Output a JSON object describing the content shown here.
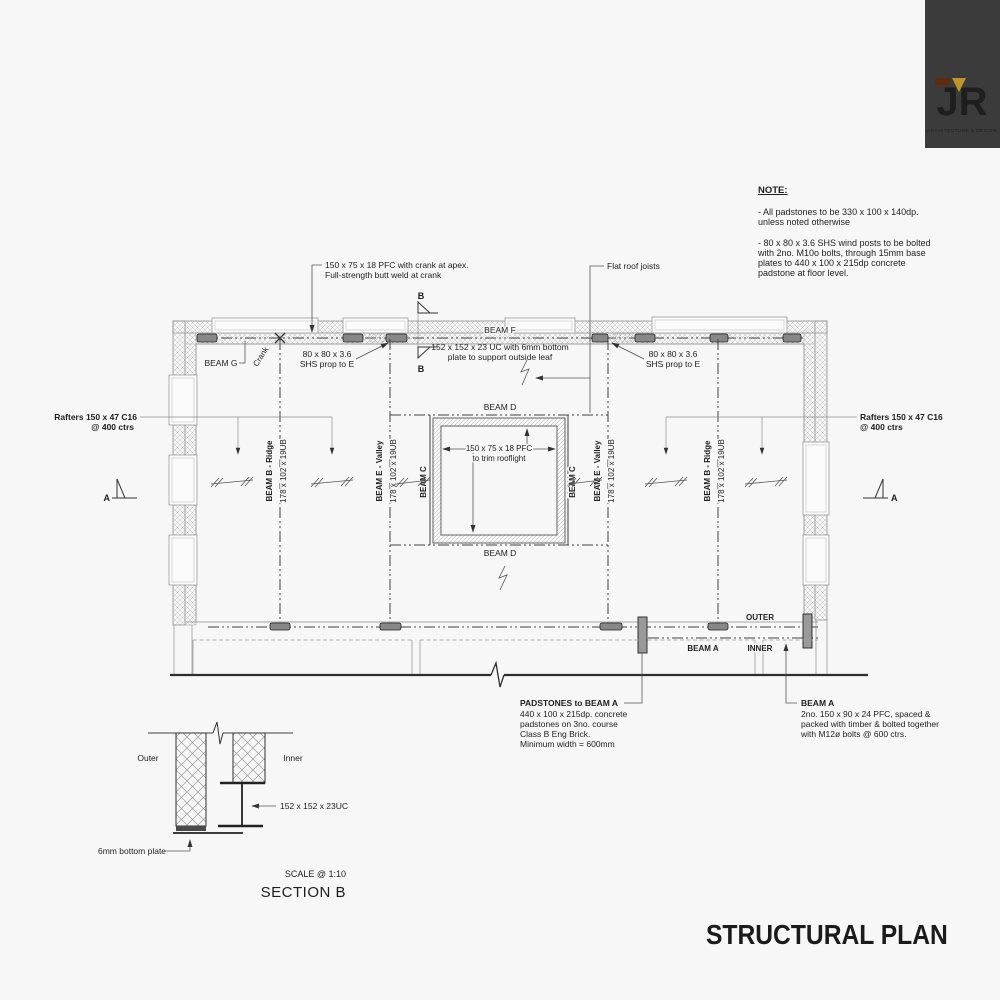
{
  "colors": {
    "page_bg": "#f7f7f7",
    "logo_bg": "#3b3b3b",
    "logo_gold": "#bd9430",
    "logo_brown": "#5c2b10",
    "ink": "#1e1e1e"
  },
  "logo": {
    "initials": "JR",
    "tagline": "ARCHITECTURE & DESIGN"
  },
  "title": "STRUCTURAL PLAN",
  "note": {
    "heading": "NOTE:",
    "para1": [
      "- All padstones to be 330 x 100 x 140dp.",
      "unless noted otherwise"
    ],
    "para2": [
      "- 80 x 80 x 3.6 SHS wind posts to be bolted",
      "with 2no. M10o bolts, through 15mm base",
      "plates to 440 x 100 x 215dp concrete",
      "padstone at floor level."
    ]
  },
  "plan": {
    "pfc_crank_line1": "150 x 75 x 18 PFC with crank at apex.",
    "pfc_crank_line2": "Full-strength butt weld at crank",
    "flat_roof_joists": "Flat roof joists",
    "beam_f": "BEAM F",
    "beam_f_spec_line1": "152 x 152 x 23 UC with 6mm bottom",
    "beam_f_spec_line2": "plate to support outside leaf",
    "beam_g": "BEAM G",
    "crank": "Crank",
    "shs_line1": "80 x 80 x 3.6",
    "shs_line2": "SHS prop to E",
    "beam_d": "BEAM D",
    "beam_c": "BEAM C",
    "ridge": "BEAM B - Ridge",
    "valley": "BEAM E - Valley",
    "ub_size": "178 x 102 x 19UB",
    "rooflight_line1": "150 x 75 x 18 PFC",
    "rooflight_line2": "to trim rooflight",
    "rafters_line1": "Rafters 150 x 47 C16",
    "rafters_line2": "@ 400 ctrs",
    "outer": "OUTER",
    "inner": "INNER",
    "beam_a": "BEAM A",
    "marker_a": "A",
    "marker_b": "B"
  },
  "padstones_note": {
    "title": "PADSTONES to BEAM A",
    "lines": [
      "440 x 100 x 215dp. concrete",
      "padstones on 3no. course",
      "Class B Eng Brick.",
      "Minimum width = 600mm"
    ]
  },
  "beam_a_note": {
    "title": "BEAM A",
    "lines": [
      "2no. 150 x 90 x 24 PFC, spaced &",
      "packed with timber & bolted together",
      "with M12ø bolts @ 600 ctrs."
    ]
  },
  "section_b": {
    "outer": "Outer",
    "inner": "Inner",
    "uc_label": "152 x 152 x 23UC",
    "plate_label": "6mm bottom plate",
    "scale": "SCALE @ 1:10",
    "title": "SECTION B"
  }
}
